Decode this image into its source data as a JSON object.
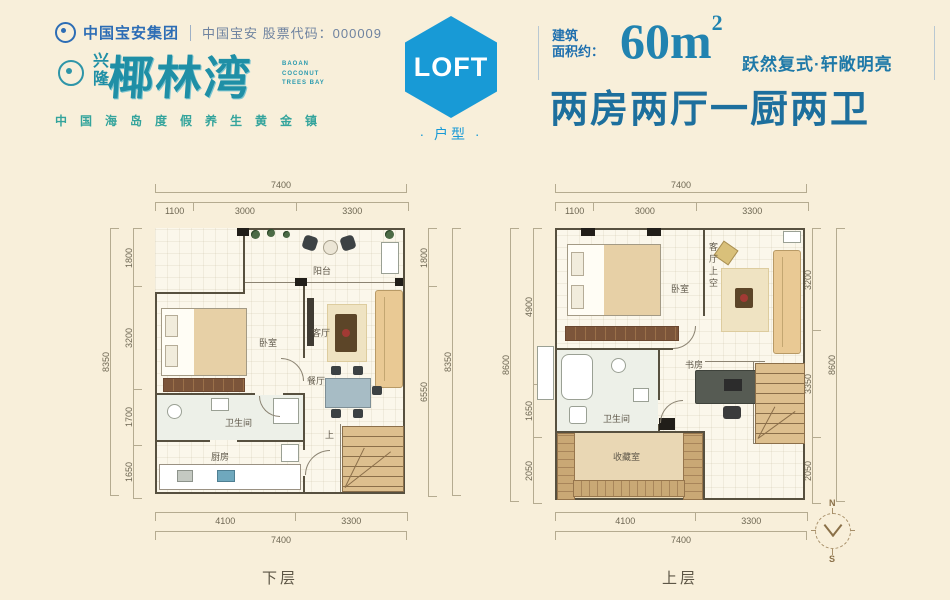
{
  "colors": {
    "accent_blue": "#189ad6",
    "deep_blue": "#1d6f9d",
    "brand_teal": "#1f8fa6",
    "tagline_teal": "#34a49c",
    "dim_line": "#b5ab90",
    "wall": "#57503f",
    "bg": "#f8efda"
  },
  "header": {
    "logo_group": "中国宝安集团",
    "stock": "中国宝安 股票代码：000009",
    "brand_seal": "兴隆",
    "brand": "椰林湾",
    "brand_en": "BAOAN COCONUT TREES BAY",
    "tagline": "中国海岛度假养生黄金镇",
    "badge": {
      "label": "LOFT",
      "sub": "· 户型 ·"
    },
    "area": {
      "l1": "建筑",
      "l2": "面积约：",
      "value": "60m",
      "sup": "2",
      "slogan": "跃然复式·轩敞明亮"
    },
    "title": "两房两厅一厨两卫"
  },
  "plans": [
    {
      "floor_label": "下层",
      "dims": {
        "top_total": "7400",
        "top_segments": [
          "1100",
          "3000",
          "3300"
        ],
        "left_total": "8350",
        "left_segments": [
          "1800",
          "3200",
          "1700",
          "1650"
        ],
        "right_total": "8350",
        "right_segments": [
          "1800",
          "6550"
        ],
        "bottom_total": "7400",
        "bottom_segments": [
          "4100",
          "3300"
        ]
      },
      "rooms": {
        "balcony": "阳台",
        "bedroom": "卧室",
        "living": "客厅",
        "dining": "餐厅",
        "bath": "卫生间",
        "kitchen": "厨房",
        "stairs_up": "上"
      }
    },
    {
      "floor_label": "上层",
      "dims": {
        "top_total": "7400",
        "top_segments": [
          "1100",
          "3000",
          "3300"
        ],
        "left_total": "8600",
        "left_segments": [
          "4900",
          "1650",
          "2050"
        ],
        "right_total": "8600",
        "right_segments": [
          "3200",
          "3350",
          "2050"
        ],
        "bottom_total": "7400",
        "bottom_segments": [
          "4100",
          "3300"
        ]
      },
      "rooms": {
        "bedroom": "卧室",
        "living_void": "客厅上空",
        "bath": "卫生间",
        "study": "书房",
        "storage": "收藏室"
      }
    }
  ],
  "compass": {
    "north": "N",
    "south": "S"
  }
}
